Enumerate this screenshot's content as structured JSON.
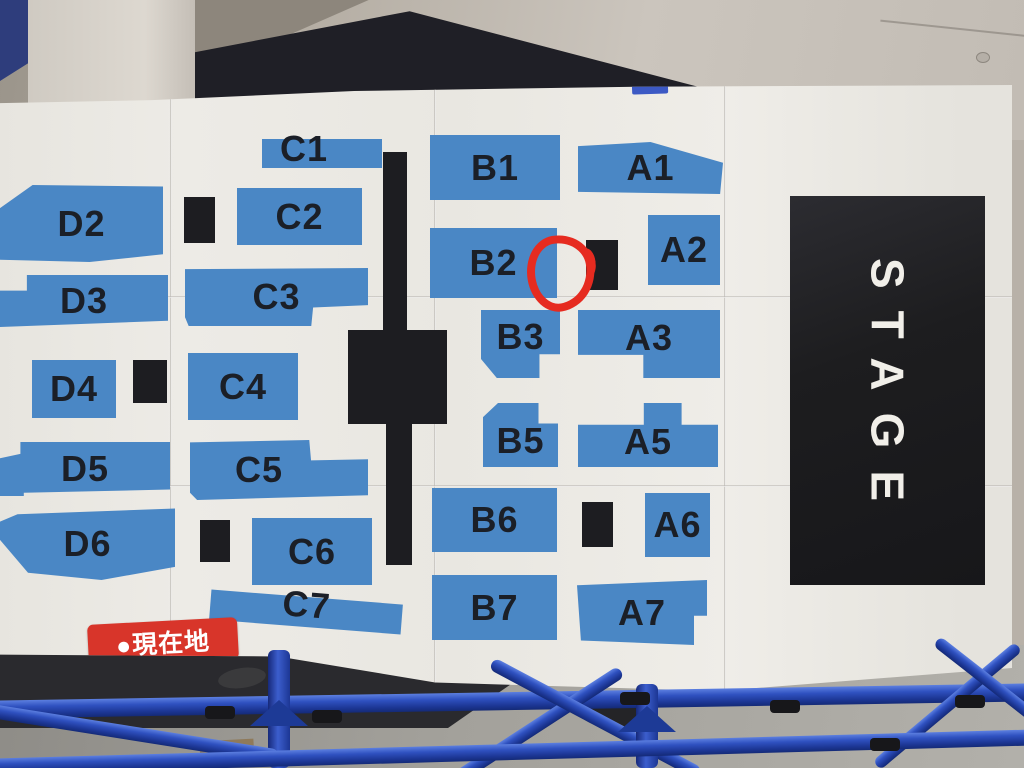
{
  "map": {
    "sections": {
      "d2": "D2",
      "d3": "D3",
      "d4": "D4",
      "d5": "D5",
      "d6": "D6",
      "c1": "C1",
      "c2": "C2",
      "c3": "C3",
      "c4": "C4",
      "c5": "C5",
      "c6": "C6",
      "c7": "C7",
      "b1": "B1",
      "b2": "B2",
      "b3": "B3",
      "b5": "B5",
      "b6": "B6",
      "b7": "B7",
      "a1": "A1",
      "a2": "A2",
      "a3": "A3",
      "a5": "A5",
      "a6": "A6",
      "a7": "A7"
    },
    "stage_label": "STAGE",
    "badge_label": "●現在地"
  },
  "colors": {
    "section_blue": "#4a87c5",
    "section_label_dark": "#1b1f27",
    "divider_black": "#1d1d21",
    "stage_bg": "#1d1d1f",
    "stage_text": "#f1efe9",
    "marker_red": "#e62b20",
    "badge_bg": "#d8352a",
    "badge_text": "#ffffff",
    "paper_white": "#e9e7e1",
    "pipe_blue": "#2746ae",
    "floor_gray": "#9b9994"
  }
}
